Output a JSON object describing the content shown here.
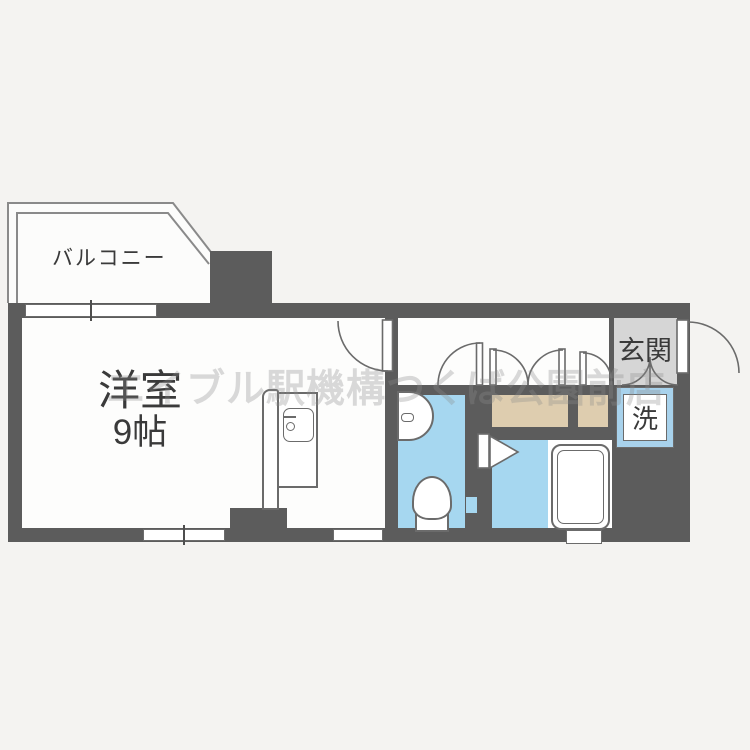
{
  "title": "apartment-floor-plan",
  "colors": {
    "wall": "#5c5c5c",
    "outline": "#6b6b6b",
    "wet": "#a6d7f0",
    "closet": "#decdaf",
    "genkan": "#d6d6d6",
    "washer_border": "#a8d2ec",
    "bg": "#f4f3f1",
    "floor": "#fdfdfc",
    "text": "#3a3a3a",
    "watermark": "#8d8d8d"
  },
  "rooms": {
    "balcony": {
      "label": "バルコニー"
    },
    "main_room": {
      "label": "洋室",
      "size": "9帖"
    },
    "entrance": {
      "label": "玄関"
    },
    "washer": {
      "label": "洗"
    }
  },
  "watermark": {
    "text": "エイブル駅機構つくば公園前店"
  }
}
